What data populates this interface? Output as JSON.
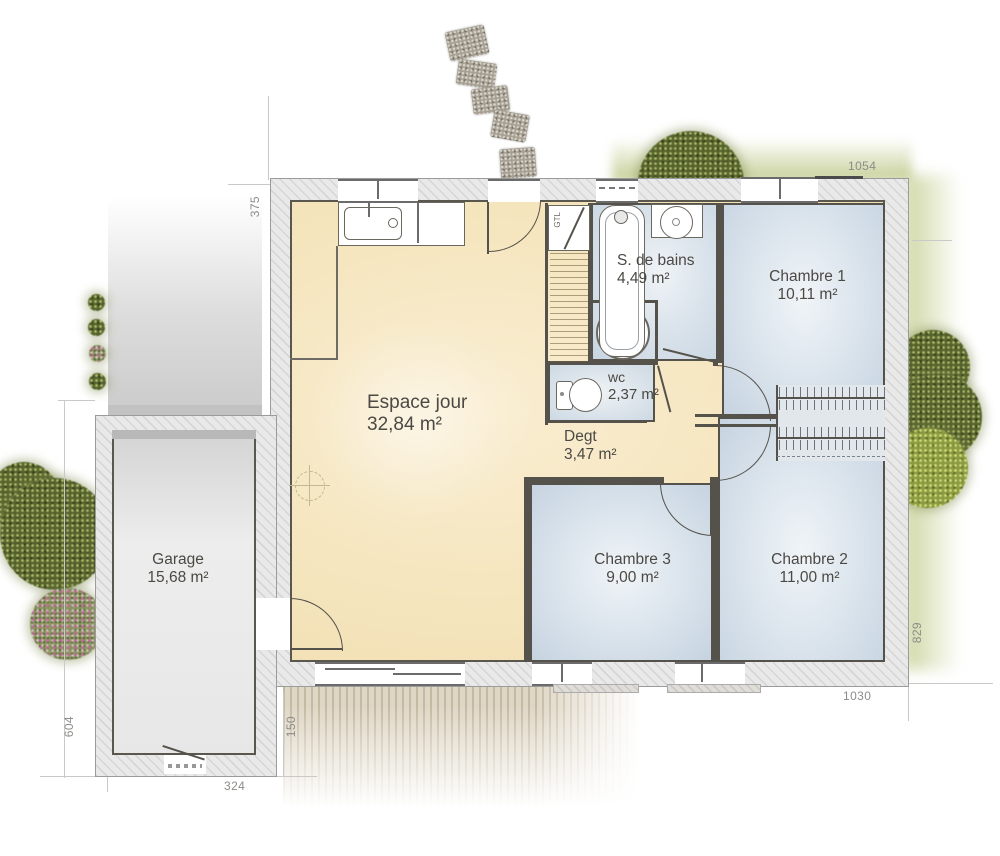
{
  "rooms": {
    "espace_jour": {
      "name": "Espace jour",
      "area": "32,84 m²"
    },
    "garage": {
      "name": "Garage",
      "area": "15,68 m²"
    },
    "sdb": {
      "name": "S. de bains",
      "area": "4,49 m²"
    },
    "chambre1": {
      "name": "Chambre 1",
      "area": "10,11 m²"
    },
    "wc": {
      "name": "wc",
      "area": "2,37 m²"
    },
    "degt": {
      "name": "Degt",
      "area": "3,47 m²"
    },
    "chambre3": {
      "name": "Chambre 3",
      "area": "9,00 m²"
    },
    "chambre2": {
      "name": "Chambre 2",
      "area": "11,00 m²"
    }
  },
  "fixtures": {
    "water_heater_label": "BEC",
    "technical_duct_label": "GTL"
  },
  "dimensions": {
    "top": "1054",
    "left_top": "375",
    "right": "829",
    "bottom_right": "1030",
    "garage_left": "604",
    "garage_bottom": "324",
    "terrace": "150"
  },
  "colors": {
    "living_floor": "#f5e5bd",
    "bedroom_floor": "#cfdbe5",
    "garage_floor": "#e6e6e6",
    "wall_fill": "#e9e9e9",
    "partition_line": "#55524b",
    "label_text": "#4b4944",
    "dimension_text": "#8c8c88",
    "vegetation": "#55622c",
    "terrace_wood": "#c6b9a2"
  }
}
